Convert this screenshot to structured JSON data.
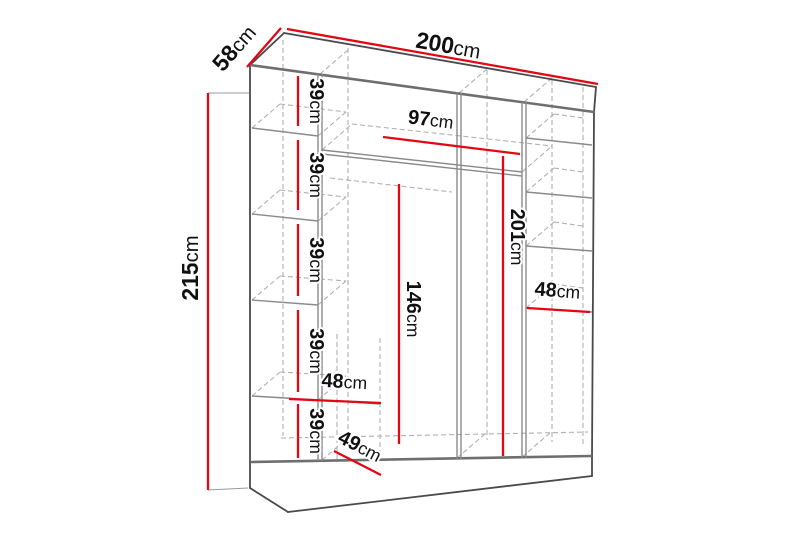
{
  "diagram": {
    "name": "wardrobe-dimension-diagram",
    "colors": {
      "dimension_red": "#e30613",
      "structure_gray": "#6e6e6e",
      "text": "#101010"
    },
    "labels": {
      "width": {
        "value": "200",
        "unit": "cm"
      },
      "depth": {
        "value": "58",
        "unit": "cm"
      },
      "height": {
        "value": "215",
        "unit": "cm"
      },
      "center_opening_width": {
        "value": "97",
        "unit": "cm"
      },
      "right_interior_height": {
        "value": "201",
        "unit": "cm"
      },
      "center_hanging_height": {
        "value": "146",
        "unit": "cm"
      },
      "right_shelf_width": {
        "value": "48",
        "unit": "cm"
      },
      "left_lower_shelf_width": {
        "value": "48",
        "unit": "cm"
      },
      "bottom_interior_depth": {
        "value": "49",
        "unit": "cm"
      },
      "left_shelf_spacings": [
        {
          "value": "39",
          "unit": "cm"
        },
        {
          "value": "39",
          "unit": "cm"
        },
        {
          "value": "39",
          "unit": "cm"
        },
        {
          "value": "39",
          "unit": "cm"
        },
        {
          "value": "39",
          "unit": "cm"
        }
      ]
    }
  }
}
